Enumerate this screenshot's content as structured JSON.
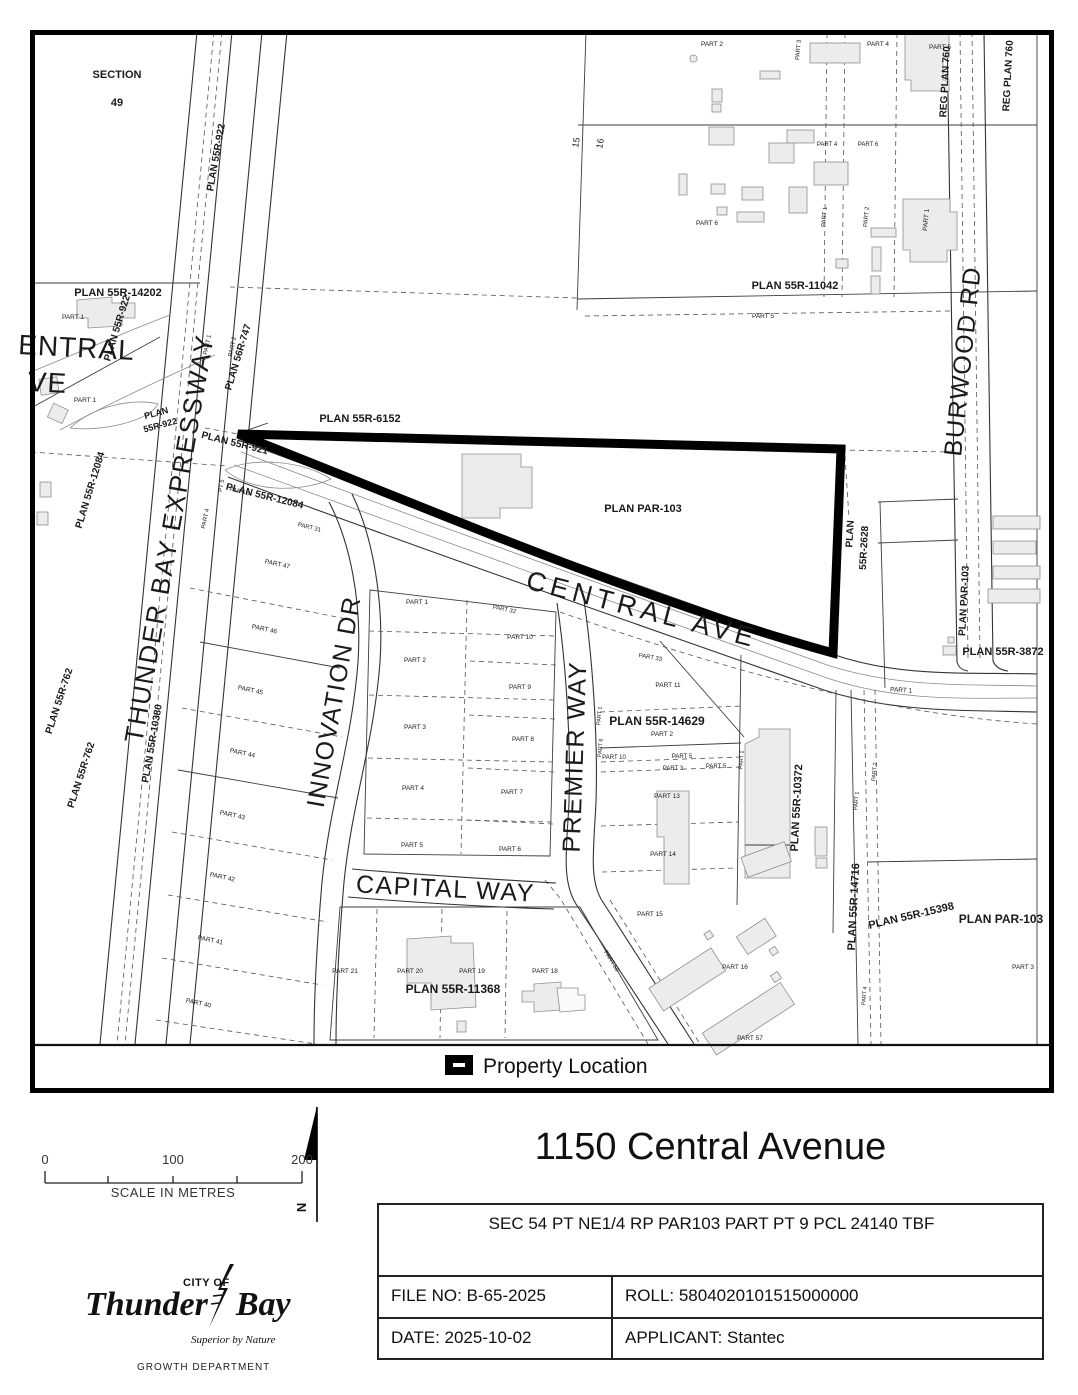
{
  "legend": {
    "label": "Property Location",
    "symbol": "property-outline-swatch"
  },
  "scale_bar": {
    "start": "0",
    "middle": "100",
    "end": "200",
    "caption": "SCALE IN METRES"
  },
  "north_arrow": {
    "label": "N"
  },
  "logo": {
    "city_of": "CITY OF",
    "name_first": "Thunder",
    "name_second": "Bay",
    "tagline": "Superior by Nature",
    "department": "GROWTH DEPARTMENT"
  },
  "title_block": {
    "title": "1150 Central Avenue",
    "legal_description": "SEC 54 PT NE1/4 RP PAR103 PART PT 9 PCL 24140 TBF",
    "file_no": "FILE NO: B-65-2025",
    "roll": "ROLL: 5804020101515000000",
    "date": "DATE: 2025-10-02",
    "applicant": "APPLICANT: Stantec"
  },
  "colors": {
    "property_outline": "#000000",
    "building_fill": "#ececec",
    "accent": "#000000"
  },
  "map": {
    "labels": [
      {
        "t": "THUNDER BAY EXPRESSWAY",
        "x": 178,
        "y": 540,
        "r": -80,
        "s": 26,
        "sp": 2,
        "n": "street-label-thunder-bay-expressway"
      },
      {
        "t": "CENTRAL AVE",
        "x": 640,
        "y": 618,
        "r": 14.5,
        "s": 27,
        "sp": 5,
        "n": "street-label-central-ave"
      },
      {
        "t": "ENTRAL",
        "x": 76,
        "y": 357,
        "r": 3,
        "s": 28,
        "sp": 1,
        "n": "street-label-central-ave-west-clip1"
      },
      {
        "t": "VE",
        "x": 47,
        "y": 392,
        "r": 3,
        "s": 28,
        "sp": 1,
        "n": "street-label-central-ave-west-clip2"
      },
      {
        "t": "INNOVATION DR",
        "x": 342,
        "y": 703,
        "r": -80,
        "s": 25,
        "sp": 1.5,
        "n": "street-label-innovation-dr"
      },
      {
        "t": "PREMIER WAY",
        "x": 583,
        "y": 757,
        "r": -88,
        "s": 25,
        "sp": 1.5,
        "n": "street-label-premier-way"
      },
      {
        "t": "CAPITAL WAY",
        "x": 445,
        "y": 897,
        "r": 3,
        "s": 25,
        "sp": 1.5,
        "n": "street-label-capital-way"
      },
      {
        "t": "BURWOOD RD",
        "x": 971,
        "y": 362,
        "r": -84,
        "s": 25,
        "sp": 1.5,
        "n": "street-label-burwood-rd"
      },
      {
        "t": "SECTION",
        "x": 117,
        "y": 78,
        "s": 11,
        "b": 1
      },
      {
        "t": "49",
        "x": 117,
        "y": 106,
        "s": 11,
        "b": 1
      },
      {
        "t": "15",
        "x": 579,
        "y": 143,
        "r": -80,
        "s": 9
      },
      {
        "t": "16",
        "x": 603,
        "y": 144,
        "r": -80,
        "s": 9
      },
      {
        "t": "PLAN 55R-922",
        "x": 219,
        "y": 158,
        "r": -80,
        "s": 10,
        "b": 1
      },
      {
        "t": "PLAN 55R-14202",
        "x": 118,
        "y": 296,
        "s": 11,
        "b": 1
      },
      {
        "t": "PLAN 55R-922",
        "x": 120,
        "y": 329,
        "r": -73,
        "s": 10,
        "b": 1
      },
      {
        "t": "PLAN 56R-747",
        "x": 241,
        "y": 358,
        "r": -73,
        "s": 10,
        "b": 1
      },
      {
        "t": "PLAN",
        "x": 157,
        "y": 416,
        "r": -15,
        "s": 9,
        "b": 1
      },
      {
        "t": "55R-922",
        "x": 161,
        "y": 428,
        "r": -15,
        "s": 9,
        "b": 1
      },
      {
        "t": "PLAN 55R-921",
        "x": 234,
        "y": 446,
        "r": 14,
        "s": 10,
        "b": 1
      },
      {
        "t": "PLAN 55R-6152",
        "x": 360,
        "y": 422,
        "s": 11,
        "b": 1
      },
      {
        "t": "PLAN 55R-12084",
        "x": 93,
        "y": 491,
        "r": -73,
        "s": 10,
        "b": 1
      },
      {
        "t": "PLAN 55R-12084",
        "x": 264,
        "y": 499,
        "r": 14,
        "s": 10,
        "b": 1
      },
      {
        "t": "PLAN 55R-762",
        "x": 62,
        "y": 702,
        "r": -72,
        "s": 10,
        "b": 1
      },
      {
        "t": "PLAN 55R-762",
        "x": 84,
        "y": 776,
        "r": -72,
        "s": 10,
        "b": 1
      },
      {
        "t": "PLAN 55R-10380",
        "x": 155,
        "y": 744,
        "r": -80,
        "s": 10,
        "b": 1
      },
      {
        "t": "PLAN 55R-11042",
        "x": 795,
        "y": 289,
        "s": 11,
        "b": 1
      },
      {
        "t": "REG PLAN 760",
        "x": 948,
        "y": 82,
        "r": -87,
        "s": 10,
        "b": 1
      },
      {
        "t": "REG PLAN 760",
        "x": 1011,
        "y": 76,
        "r": -87,
        "s": 10,
        "b": 1
      },
      {
        "t": "PLAN PAR-103",
        "x": 643,
        "y": 512,
        "s": 11,
        "b": 1
      },
      {
        "t": "PLAN",
        "x": 853,
        "y": 534,
        "r": -87,
        "s": 10,
        "b": 1
      },
      {
        "t": "55R-2628",
        "x": 867,
        "y": 548,
        "r": -87,
        "s": 10,
        "b": 1
      },
      {
        "t": "PLAN PAR-103",
        "x": 967,
        "y": 601,
        "r": -87,
        "s": 10,
        "b": 1
      },
      {
        "t": "PLAN 55R-3872",
        "x": 1003,
        "y": 655,
        "s": 11,
        "b": 1
      },
      {
        "t": "PLAN 55R-14629",
        "x": 657,
        "y": 725,
        "s": 12,
        "b": 1
      },
      {
        "t": "PLAN 55R-10372",
        "x": 800,
        "y": 808,
        "r": -87,
        "s": 11,
        "b": 1
      },
      {
        "t": "PLAN 55R-14716",
        "x": 857,
        "y": 907,
        "r": -87,
        "s": 11,
        "b": 1
      },
      {
        "t": "PLAN 55R-15398",
        "x": 912,
        "y": 919,
        "r": -13,
        "s": 11,
        "b": 1
      },
      {
        "t": "PLAN PAR-103",
        "x": 1001,
        "y": 923,
        "s": 12,
        "b": 1
      },
      {
        "t": "PLAN 55R-11368",
        "x": 453,
        "y": 993,
        "s": 12,
        "b": 1
      },
      {
        "t": "PART 1",
        "x": 73,
        "y": 319,
        "s": 6.5
      },
      {
        "t": "PART 1",
        "x": 85,
        "y": 402,
        "s": 6.5
      },
      {
        "t": "PART 1",
        "x": 209,
        "y": 345,
        "r": -78,
        "s": 6
      },
      {
        "t": "PART 2",
        "x": 234,
        "y": 347,
        "r": -78,
        "s": 6
      },
      {
        "t": "PT 5",
        "x": 223,
        "y": 486,
        "r": -78,
        "s": 6
      },
      {
        "t": "PART 3",
        "x": 239,
        "y": 493,
        "r": 14,
        "s": 6
      },
      {
        "t": "PART 4",
        "x": 207,
        "y": 519,
        "r": -78,
        "s": 6
      },
      {
        "t": "PART 31",
        "x": 309,
        "y": 529,
        "r": 14,
        "s": 6
      },
      {
        "t": "PART 47",
        "x": 277,
        "y": 566,
        "r": 12,
        "s": 6.5
      },
      {
        "t": "PART 46",
        "x": 264,
        "y": 631,
        "r": 12,
        "s": 6.5
      },
      {
        "t": "PART 45",
        "x": 250,
        "y": 692,
        "r": 12,
        "s": 6.5
      },
      {
        "t": "PART 44",
        "x": 242,
        "y": 755,
        "r": 12,
        "s": 6.5
      },
      {
        "t": "PART 43",
        "x": 232,
        "y": 817,
        "r": 12,
        "s": 6.5
      },
      {
        "t": "PART 42",
        "x": 222,
        "y": 879,
        "r": 12,
        "s": 6.5
      },
      {
        "t": "PART 41",
        "x": 210,
        "y": 942,
        "r": 12,
        "s": 6.5
      },
      {
        "t": "PART 40",
        "x": 198,
        "y": 1005,
        "r": 12,
        "s": 6.5
      },
      {
        "t": "PART 1",
        "x": 417,
        "y": 604,
        "s": 6.5
      },
      {
        "t": "PART 2",
        "x": 415,
        "y": 662,
        "s": 6.5
      },
      {
        "t": "PART 3",
        "x": 415,
        "y": 729,
        "s": 6.5
      },
      {
        "t": "PART 4",
        "x": 413,
        "y": 790,
        "s": 6.5
      },
      {
        "t": "PART 5",
        "x": 412,
        "y": 847,
        "s": 6.5
      },
      {
        "t": "PART 32",
        "x": 504,
        "y": 611,
        "r": 12,
        "s": 6
      },
      {
        "t": "PART 10",
        "x": 520,
        "y": 639,
        "s": 6.5
      },
      {
        "t": "PART 9",
        "x": 520,
        "y": 689,
        "s": 6.5
      },
      {
        "t": "PART 8",
        "x": 523,
        "y": 741,
        "s": 6.5
      },
      {
        "t": "PART 7",
        "x": 512,
        "y": 794,
        "s": 6.5
      },
      {
        "t": "PART 6",
        "x": 510,
        "y": 851,
        "s": 6.5
      },
      {
        "t": "PART 33",
        "x": 650,
        "y": 659,
        "r": 10,
        "s": 6
      },
      {
        "t": "PART 11",
        "x": 668,
        "y": 687,
        "s": 6.5
      },
      {
        "t": "PART 2",
        "x": 662,
        "y": 736,
        "s": 6.5
      },
      {
        "t": "PART 10",
        "x": 614,
        "y": 759,
        "s": 6
      },
      {
        "t": "PART 5",
        "x": 682,
        "y": 758,
        "s": 6
      },
      {
        "t": "PART 3",
        "x": 673,
        "y": 770,
        "s": 6
      },
      {
        "t": "PART 5",
        "x": 716,
        "y": 768,
        "s": 6
      },
      {
        "t": "PART 6",
        "x": 602,
        "y": 748,
        "r": -85,
        "s": 5.5
      },
      {
        "t": "PART 1",
        "x": 601,
        "y": 716,
        "r": -85,
        "s": 5.5
      },
      {
        "t": "PART 1",
        "x": 743,
        "y": 760,
        "r": -85,
        "s": 5.5
      },
      {
        "t": "PART 13",
        "x": 667,
        "y": 798,
        "s": 6.5
      },
      {
        "t": "PART 14",
        "x": 663,
        "y": 856,
        "s": 6.5
      },
      {
        "t": "PART 15",
        "x": 650,
        "y": 916,
        "s": 6.5
      },
      {
        "t": "PART 16",
        "x": 735,
        "y": 969,
        "s": 6.5
      },
      {
        "t": "PART 57",
        "x": 750,
        "y": 1040,
        "s": 6.5
      },
      {
        "t": "PART 59",
        "x": 610,
        "y": 962,
        "r": 58,
        "s": 6
      },
      {
        "t": "PART 21",
        "x": 345,
        "y": 973,
        "s": 6.5
      },
      {
        "t": "PART 20",
        "x": 410,
        "y": 973,
        "s": 6.5
      },
      {
        "t": "PART 19",
        "x": 472,
        "y": 973,
        "s": 6.5
      },
      {
        "t": "PART 18",
        "x": 545,
        "y": 973,
        "s": 6.5
      },
      {
        "t": "PART 1",
        "x": 901,
        "y": 692,
        "r": 4,
        "s": 6.5
      },
      {
        "t": "PART 1",
        "x": 858,
        "y": 801,
        "r": -85,
        "s": 5.5
      },
      {
        "t": "PART 2",
        "x": 876,
        "y": 772,
        "r": -85,
        "s": 5.5
      },
      {
        "t": "PART 4",
        "x": 866,
        "y": 996,
        "r": -85,
        "s": 5.5
      },
      {
        "t": "PART 3",
        "x": 1023,
        "y": 969,
        "s": 6.5
      },
      {
        "t": "PART 2",
        "x": 712,
        "y": 46,
        "s": 6.5
      },
      {
        "t": "PART 3",
        "x": 800,
        "y": 50,
        "r": -85,
        "s": 6
      },
      {
        "t": "PART 4",
        "x": 878,
        "y": 46,
        "s": 6.5
      },
      {
        "t": "PART 5",
        "x": 940,
        "y": 49,
        "s": 6.5
      },
      {
        "t": "PART 4",
        "x": 827,
        "y": 146,
        "s": 6
      },
      {
        "t": "PART 6",
        "x": 868,
        "y": 146,
        "s": 6
      },
      {
        "t": "PART 6",
        "x": 707,
        "y": 225,
        "s": 6.5
      },
      {
        "t": "PART 1",
        "x": 826,
        "y": 217,
        "r": -85,
        "s": 6
      },
      {
        "t": "PART 2",
        "x": 868,
        "y": 217,
        "r": -85,
        "s": 6
      },
      {
        "t": "PART 1",
        "x": 928,
        "y": 220,
        "r": -85,
        "s": 6.5
      },
      {
        "t": "PART 5",
        "x": 763,
        "y": 318,
        "s": 6.5
      }
    ]
  }
}
